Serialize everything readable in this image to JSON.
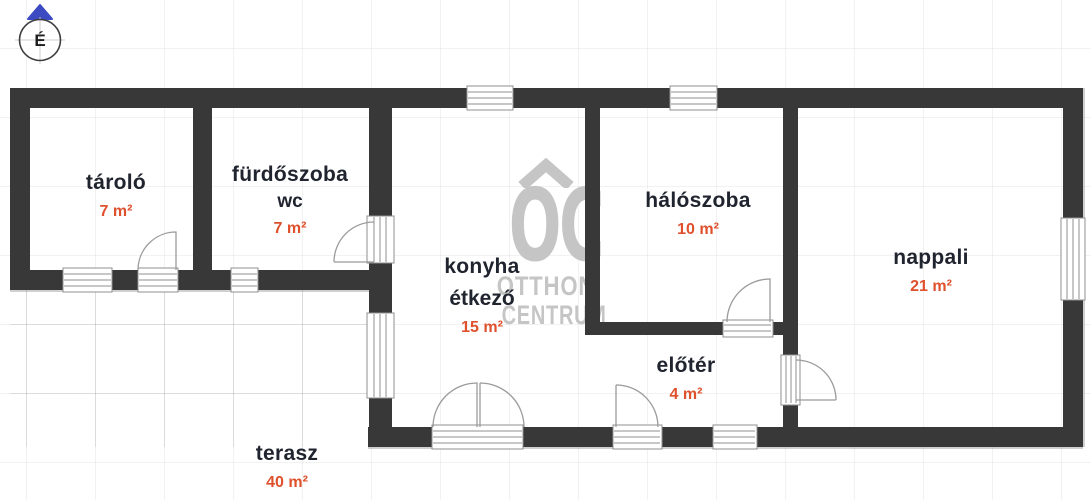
{
  "compass": {
    "label": "É"
  },
  "watermark": {
    "logo": "OC",
    "line1": "OTTHON",
    "line2": "CENTRUM"
  },
  "rooms": [
    {
      "name": "tároló",
      "area": "7 m²"
    },
    {
      "name": "fürdőszoba",
      "name2": "wc",
      "area": "7 m²"
    },
    {
      "name": "konyha",
      "name2": "étkező",
      "area": "15 m²"
    },
    {
      "name": "hálószoba",
      "area": "10 m²"
    },
    {
      "name": "nappali",
      "area": "21 m²"
    },
    {
      "name": "előtér",
      "area": "4 m²"
    },
    {
      "name": "terasz",
      "area": "40 m²"
    }
  ],
  "colors": {
    "wall": "#383838",
    "label": "#20242e",
    "accent": "#df502d",
    "watermark": "#c5c5c5",
    "compass_blue": "#3c4bc2"
  }
}
